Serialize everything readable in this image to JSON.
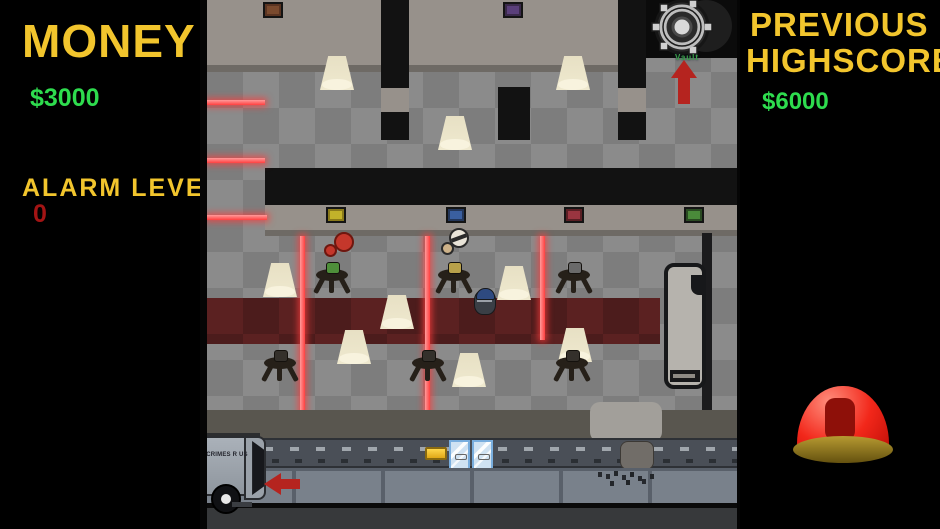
{
  "hud": {
    "money": {
      "label": "MONEY",
      "value": "$3000"
    },
    "alarm": {
      "label": "ALARM LEVEL",
      "value": "0"
    },
    "highscore": {
      "line1": "PREVIOUS",
      "line2": "HIGHSCORE",
      "value": "$6000"
    }
  },
  "game": {
    "vault_label": "Vault",
    "truck_text": "CRIMES R US"
  },
  "colors": {
    "hud_yellow": "#f2c52d",
    "hud_green": "#2edc4e",
    "alarm_red": "#a31414",
    "laser_red": "#ff5555",
    "carpet_red": "#5b2121",
    "button_red": "#ee1c0f",
    "button_base_gold": "#a08a28",
    "floor_gray": "#8b8b8b",
    "wall_gray": "#97918b"
  }
}
